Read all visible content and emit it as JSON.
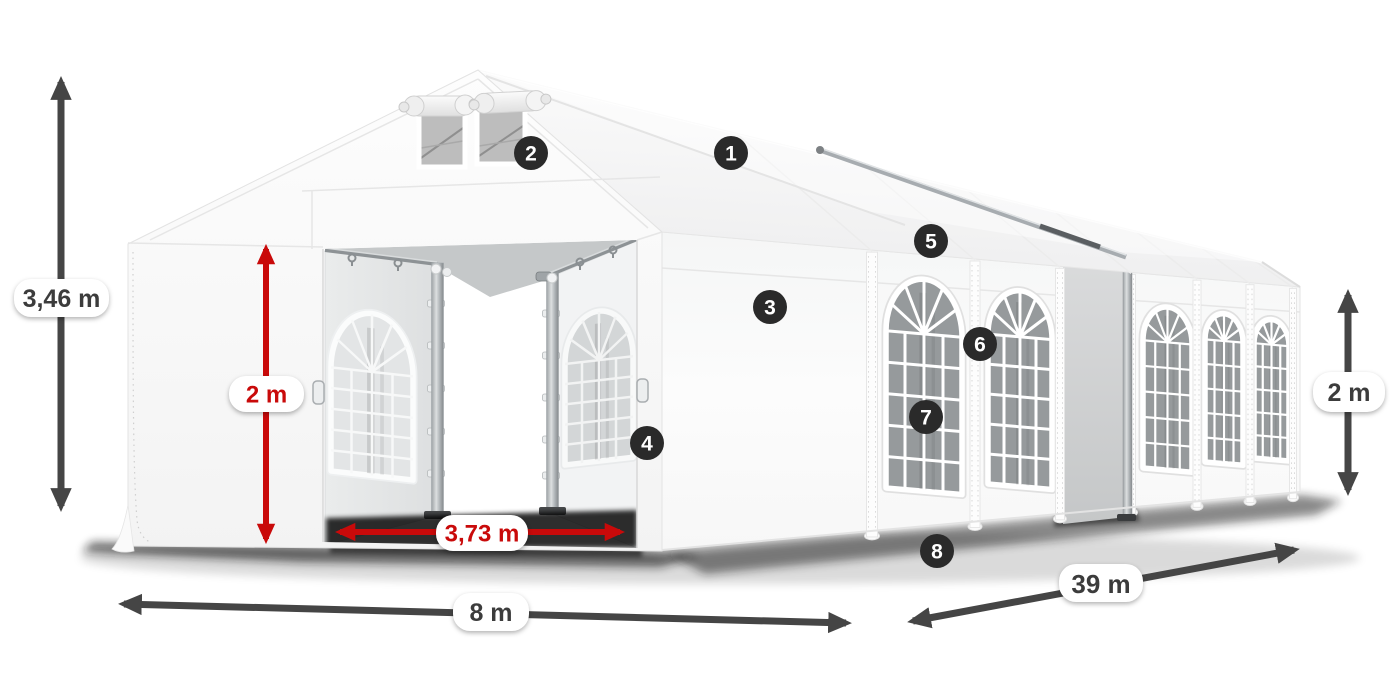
{
  "diagram": {
    "type": "product-dimension-diagram",
    "subject": "white party marquee tent with numbered feature callouts",
    "dimension_labels": {
      "total_height": "3,46 m",
      "entrance_height": "2 m",
      "entrance_width": "3,73 m",
      "ground_width": "8 m",
      "length": "39 m",
      "side_height": "2 m"
    },
    "callouts": [
      "1",
      "2",
      "3",
      "4",
      "5",
      "6",
      "7",
      "8"
    ],
    "colors": {
      "accent_red": "#c90a0a",
      "arrow_dark": "#454545",
      "marker_dark": "#2a2a2a",
      "label_dark": "#3c3c3c",
      "pill_bg": "#ffffff"
    }
  }
}
